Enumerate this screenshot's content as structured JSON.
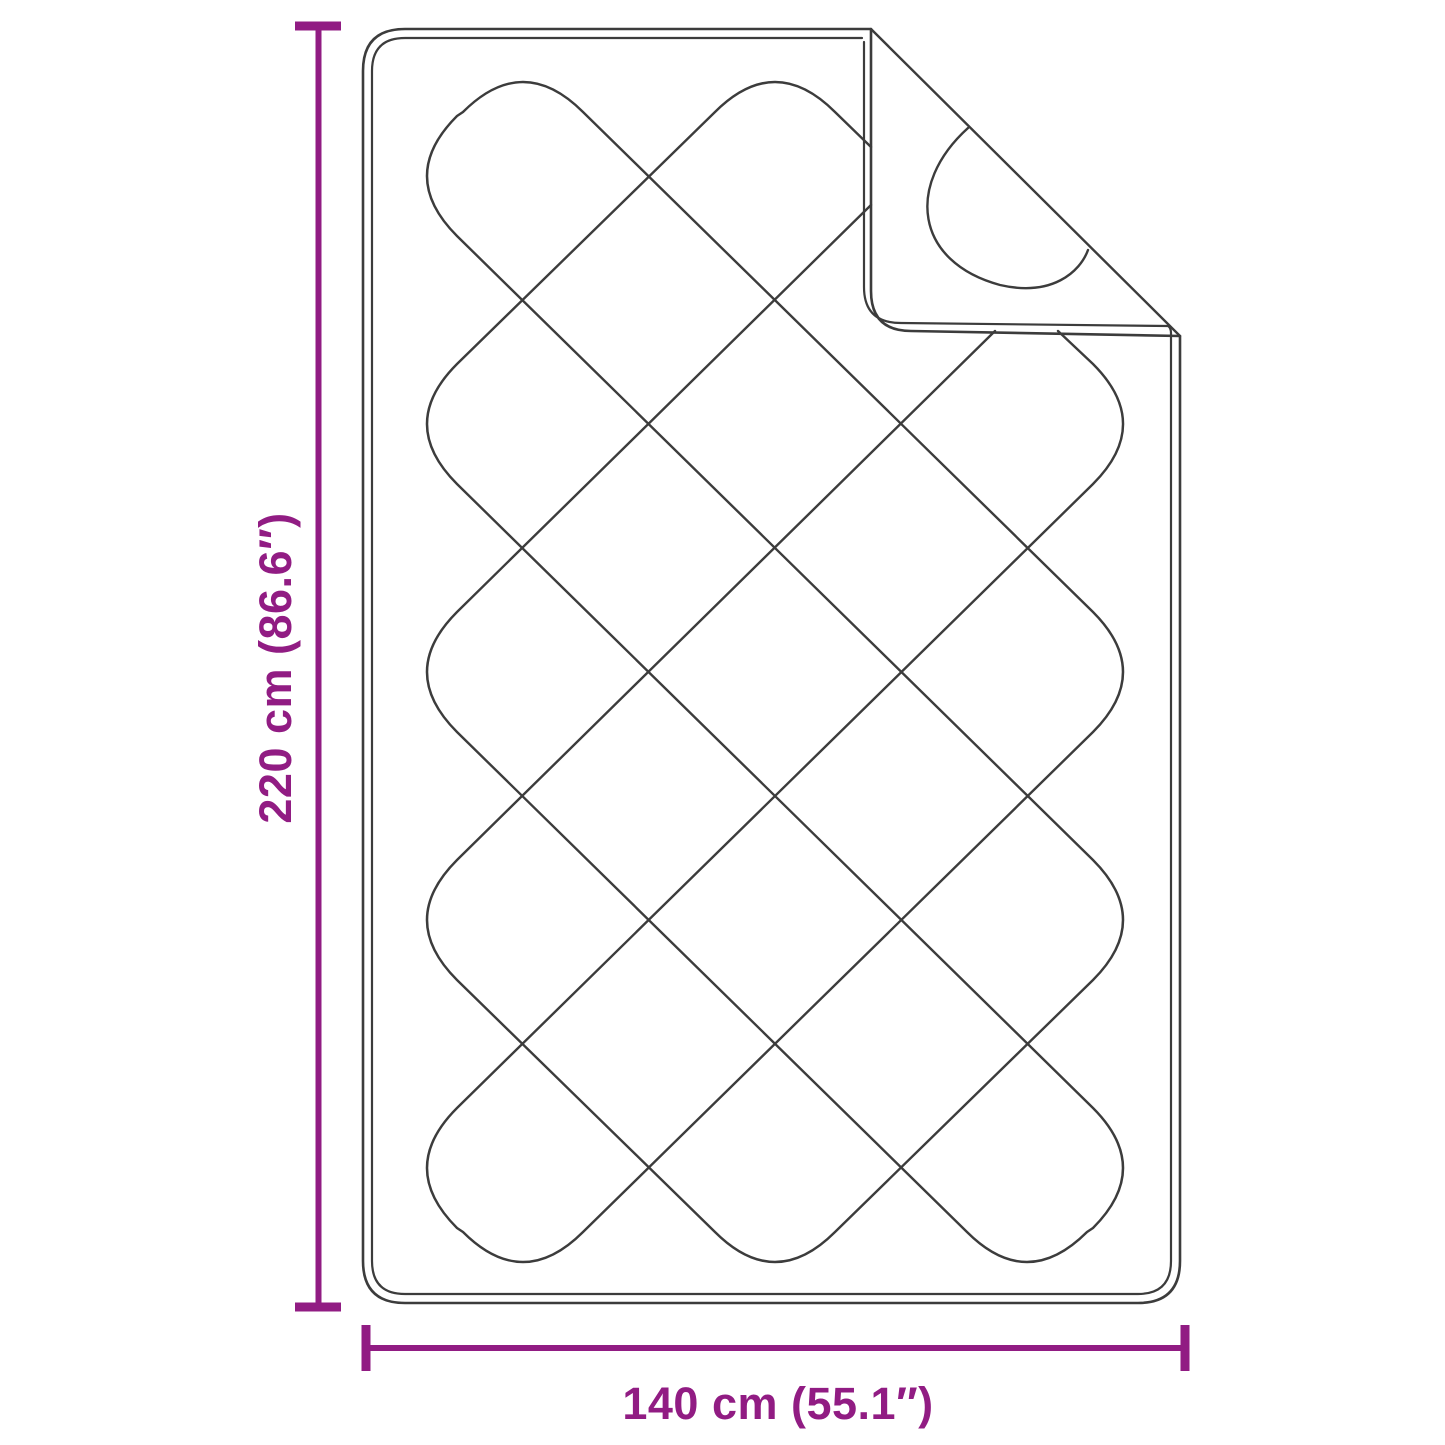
{
  "dimensions": {
    "height_label": "220 cm (86.6″)",
    "width_label": "140 cm (55.1″)"
  },
  "colors": {
    "dimension": "#911C83",
    "line_art": "#3C3C3C",
    "background": "#FFFFFF"
  }
}
